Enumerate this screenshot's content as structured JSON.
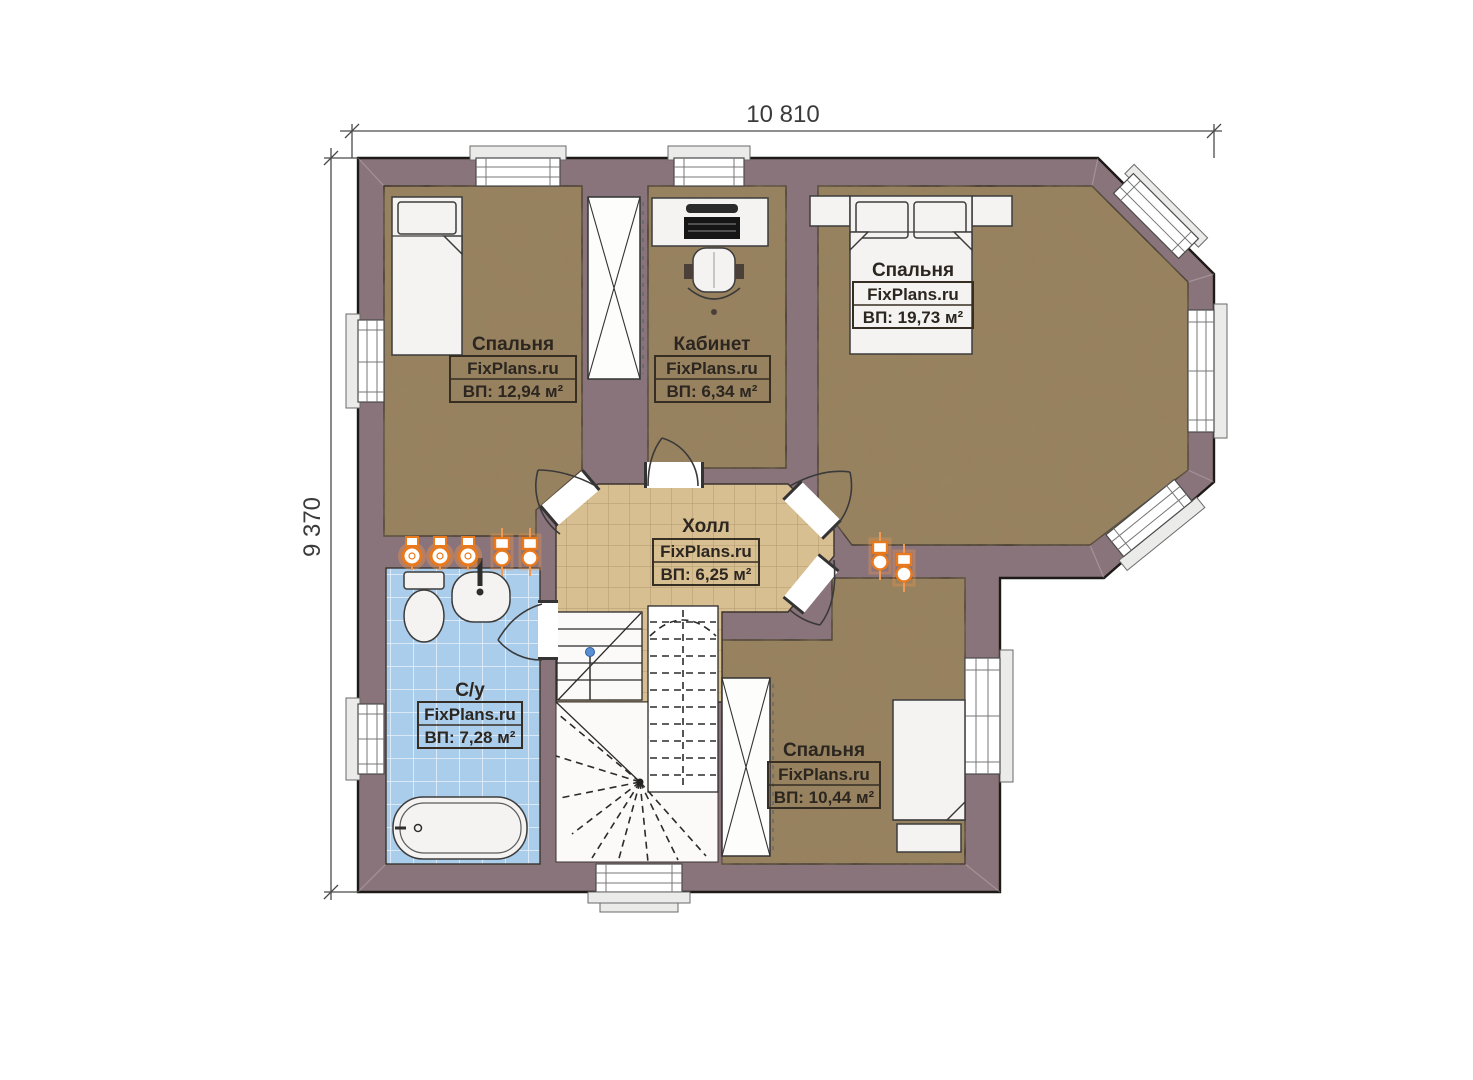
{
  "plan": {
    "dim_width_label": "10 810",
    "dim_height_label": "9 370",
    "rooms": [
      {
        "name": "Спальня",
        "brand": "FixPlans.ru",
        "area": "ВП: 12,94 м²"
      },
      {
        "name": "Кабинет",
        "brand": "FixPlans.ru",
        "area": "ВП: 6,34 м²"
      },
      {
        "name": "Спальня",
        "brand": "FixPlans.ru",
        "area": "ВП: 19,73 м²"
      },
      {
        "name": "Холл",
        "brand": "FixPlans.ru",
        "area": "ВП: 6,25 м²"
      },
      {
        "name": "С/у",
        "brand": "FixPlans.ru",
        "area": "ВП: 7,28 м²"
      },
      {
        "name": "Спальня",
        "brand": "FixPlans.ru",
        "area": "ВП: 10,44 м²"
      }
    ],
    "colors": {
      "wall": "#8a747b",
      "floor": "#98815f",
      "hall_tile": "#d8bf92",
      "bath_tile": "#abcdec",
      "riser_orange": "#e8791d"
    }
  }
}
